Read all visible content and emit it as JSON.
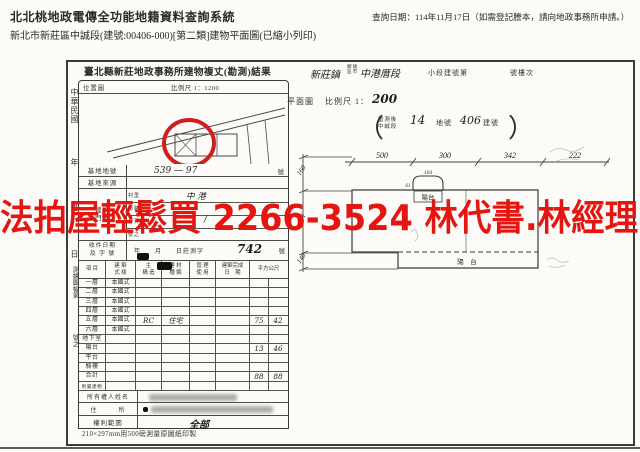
{
  "header": {
    "system_title": "北北桃地政電傳全功能地籍資料查詢系統",
    "query_date": "查詢日期：114年11月17日（如需登記謄本，請向地政事務所申請。）",
    "subtitle": "新北市新莊區中誠段(建號:00406-000)[第二類]建物平面圖(已縮小列印)"
  },
  "watermark": {
    "text": "法拍屋輕鬆買 2266-3524 林代書.林經理",
    "color": "#e51511"
  },
  "left_margin": {
    "era": "中華民國",
    "year": "年",
    "month": "月",
    "day": "日",
    "sheet": "測繪圖幅第",
    "number": "號之"
  },
  "survey_form": {
    "title": "臺北縣新莊地政事務所建物複丈(勘測)結果",
    "location_map_label": "位置圖",
    "location_map_scale": "比例尺 1：1200",
    "lot_label": "基地地號",
    "lot_value": "539 — 97",
    "lot_suffix": "號",
    "source_label": "基地來源",
    "address_label": "建物\n門牌",
    "address_subrows": [
      {
        "label": "村里",
        "value": "中 港"
      },
      {
        "label": "街路",
        "value": ""
      },
      {
        "label": "巷弄",
        "value": "/"
      },
      {
        "label": "號之",
        "value": ""
      }
    ],
    "receipt_label": "收件日期\n及 字 號",
    "receipt_printed": "年　　月　　日莊測字",
    "receipt_number": "742",
    "receipt_suffix": "號",
    "table": {
      "headers": [
        "項 目",
        "建 築\n式 樣",
        "主\n構 造",
        "建 材\n種 類",
        "管 理\n使 用",
        "建築完成\n日　期",
        "平方公尺"
      ],
      "rows": [
        [
          "一層",
          "本國式",
          "",
          "",
          "",
          "",
          "",
          ""
        ],
        [
          "二層",
          "本國式",
          "",
          "",
          "",
          "",
          "",
          ""
        ],
        [
          "三層",
          "本國式",
          "",
          "",
          "",
          "",
          "",
          ""
        ],
        [
          "四層",
          "本國式",
          "",
          "",
          "",
          "",
          "",
          ""
        ],
        [
          "五層",
          "本國式",
          "RC",
          "住宅",
          "",
          "",
          "75",
          "42"
        ],
        [
          "六層",
          "本國式",
          "",
          "",
          "",
          "",
          "",
          ""
        ],
        [
          "地下室",
          "",
          "",
          "",
          "",
          "",
          "",
          ""
        ],
        [
          "陽台",
          "",
          "",
          "",
          "",
          "",
          "13",
          "46"
        ],
        [
          "平台",
          "",
          "",
          "",
          "",
          "",
          "",
          ""
        ],
        [
          "騎樓",
          "",
          "",
          "",
          "",
          "",
          "",
          ""
        ],
        [
          "合計",
          "",
          "",
          "",
          "",
          "",
          "88",
          "88"
        ],
        [
          "附屬建物",
          "",
          "",
          "",
          "",
          "",
          "",
          ""
        ]
      ]
    },
    "owner_label": "所有權人姓名",
    "owner_address_label": "住　　　所",
    "rights_label": "權利範圍",
    "rights_value": "全部",
    "footnote": "210×297mm用500磅測量原圖紙印製"
  },
  "plan_panel": {
    "township_handwritten": "新莊鎮",
    "township_printed": "鄉鎮\n區市",
    "section_handwritten": "中港厝段",
    "subsection_printed": "小段建號第",
    "floor_printed": "號樓次",
    "plan_label": "平面圖",
    "scale_printed": "比例尺 1：",
    "scale_value": "200",
    "resurvey": {
      "stack": "重測後\n中誠段",
      "lot_value": "14",
      "lot_suffix": "地號",
      "bldg_value": "406",
      "bldg_suffix": "建號",
      "open": "（",
      "close": "）"
    },
    "dims_top": [
      "500",
      "300",
      "342",
      "222"
    ],
    "dims_left": [
      "160",
      "441",
      "140"
    ],
    "dim_small_h": "103",
    "dim_small_v": "61",
    "balcony_top": "陽台",
    "balcony_bottom": "陽　台"
  }
}
